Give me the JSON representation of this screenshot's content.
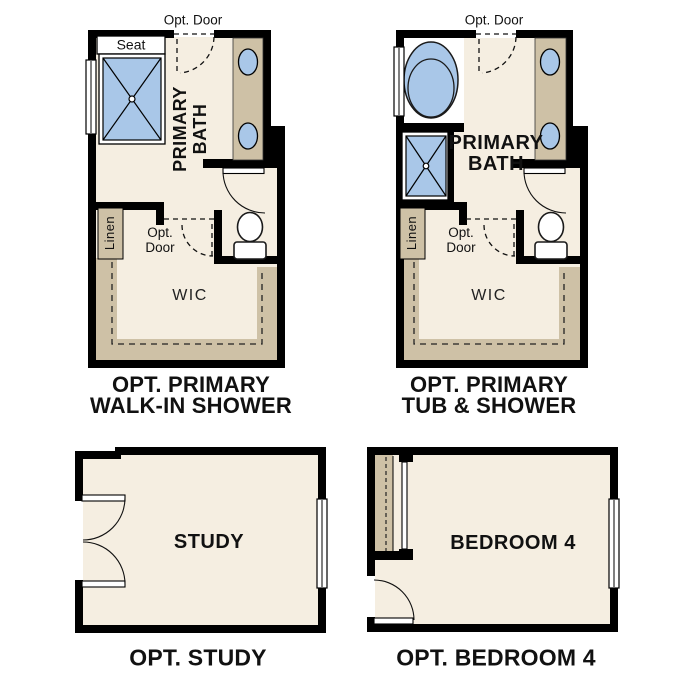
{
  "colors": {
    "floor": "#F5EEE1",
    "cabinet_tan": "#CEC1A6",
    "fixture_blue": "#A9C7E8",
    "wall_black": "#000000",
    "text": "#111111"
  },
  "plans": {
    "walk_in_shower": {
      "opt_door_top": "Opt. Door",
      "seat": "Seat",
      "room_line1": "PRIMARY",
      "room_line2": "BATH",
      "linen": "Linen",
      "opt_door_mid_line1": "Opt.",
      "opt_door_mid_line2": "Door",
      "wic": "WIC",
      "caption_line1": "OPT. PRIMARY",
      "caption_line2": "WALK-IN SHOWER"
    },
    "tub_shower": {
      "opt_door_top": "Opt. Door",
      "room_line1": "PRIMARY",
      "room_line2": "BATH",
      "linen": "Linen",
      "opt_door_mid_line1": "Opt.",
      "opt_door_mid_line2": "Door",
      "wic": "WIC",
      "caption_line1": "OPT. PRIMARY",
      "caption_line2": "TUB & SHOWER"
    },
    "study": {
      "room": "STUDY",
      "caption": "OPT. STUDY"
    },
    "bedroom4": {
      "room": "BEDROOM 4",
      "caption": "OPT. BEDROOM 4"
    }
  }
}
